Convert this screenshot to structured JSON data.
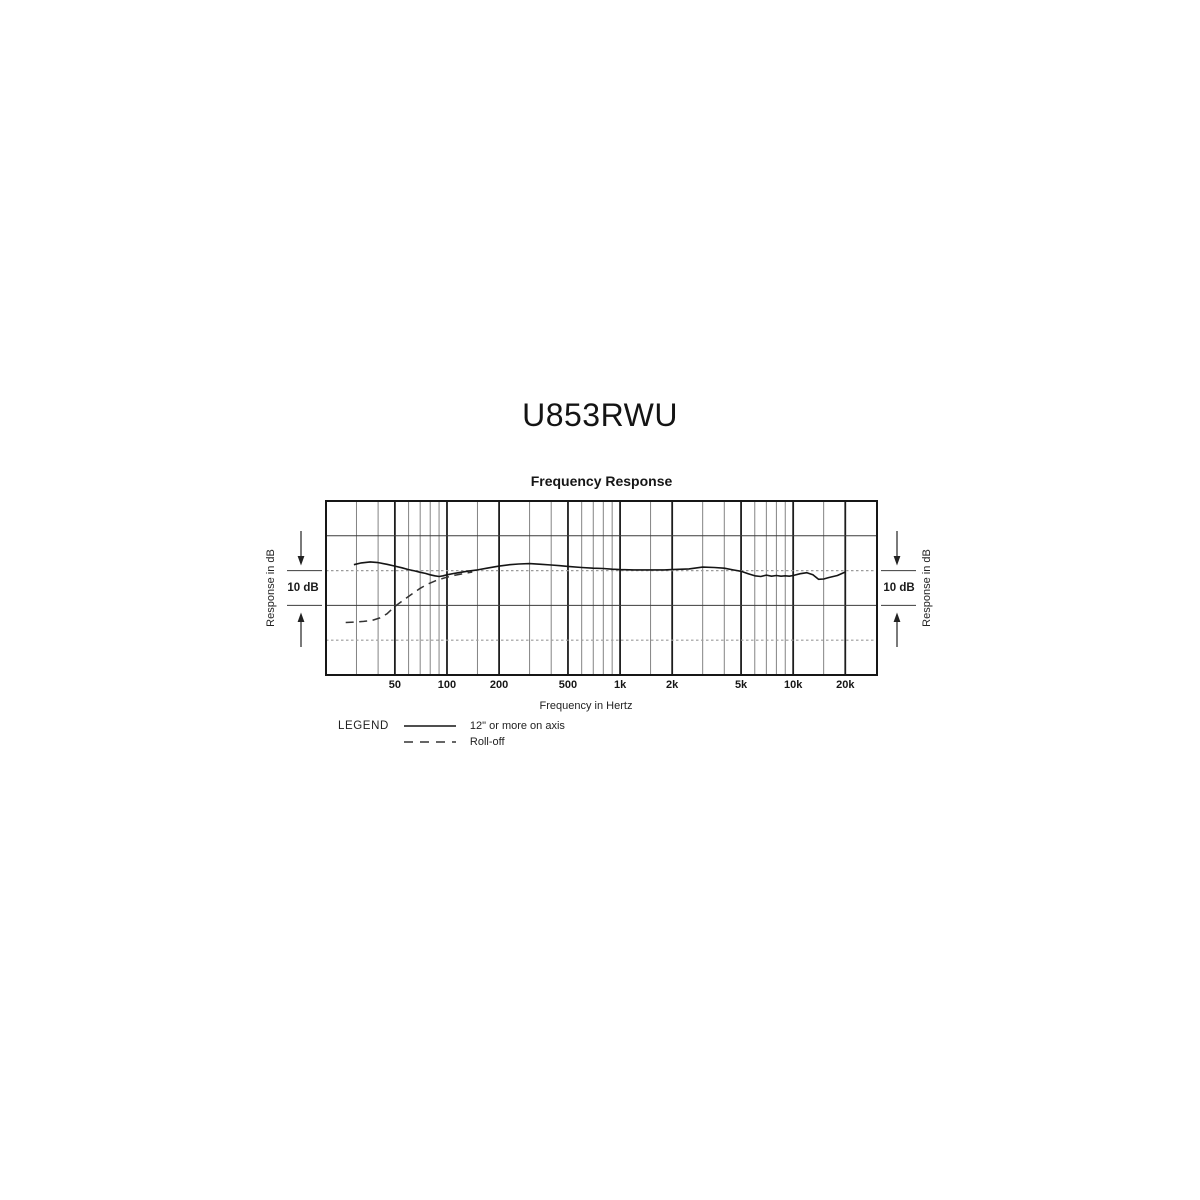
{
  "page": {
    "title": "U853RWU"
  },
  "chart": {
    "heading": "Frequency Response",
    "xlabel": "Frequency in Hertz",
    "ylabel_left": "Response in dB",
    "ylabel_right": "Response in dB",
    "scale_label": "10 dB",
    "legend": {
      "title": "LEGEND",
      "items": [
        {
          "style": "solid",
          "label": "12\" or more on axis"
        },
        {
          "style": "dashed",
          "label": "Roll-off"
        }
      ]
    }
  },
  "chart_data": {
    "type": "line",
    "title": "Frequency Response",
    "xlabel": "Frequency in Hertz",
    "ylabel": "Response in dB",
    "x_scale": "log",
    "x_unit": "Hz",
    "x_range": [
      20,
      30500
    ],
    "y_unit": "dB",
    "y_range": [
      -30,
      20
    ],
    "y_division_db": 10,
    "grid": true,
    "legend_position": "below-left",
    "major_ticks": [
      {
        "f": 50,
        "label": "50"
      },
      {
        "f": 100,
        "label": "100"
      },
      {
        "f": 200,
        "label": "200"
      },
      {
        "f": 500,
        "label": "500"
      },
      {
        "f": 1000,
        "label": "1k"
      },
      {
        "f": 2000,
        "label": "2k"
      },
      {
        "f": 5000,
        "label": "5k"
      },
      {
        "f": 10000,
        "label": "10k"
      },
      {
        "f": 20000,
        "label": "20k"
      }
    ],
    "minor_ticks": [
      30,
      40,
      60,
      70,
      80,
      90,
      150,
      300,
      400,
      600,
      700,
      800,
      900,
      1500,
      3000,
      4000,
      6000,
      7000,
      8000,
      9000,
      15000
    ],
    "reference_lines_db": {
      "solid": [
        10,
        -10
      ],
      "dashed": [
        0,
        -20
      ]
    },
    "series": [
      {
        "name": "12\" or more on axis",
        "style": "solid",
        "points": [
          [
            29,
            1.7
          ],
          [
            32,
            2.2
          ],
          [
            36,
            2.5
          ],
          [
            40,
            2.3
          ],
          [
            45,
            1.8
          ],
          [
            50,
            1.3
          ],
          [
            55,
            0.8
          ],
          [
            60,
            0.3
          ],
          [
            65,
            -0.1
          ],
          [
            70,
            -0.5
          ],
          [
            75,
            -0.8
          ],
          [
            80,
            -1.2
          ],
          [
            85,
            -1.5
          ],
          [
            90,
            -1.7
          ],
          [
            95,
            -1.5
          ],
          [
            100,
            -1.2
          ],
          [
            110,
            -0.8
          ],
          [
            120,
            -0.5
          ],
          [
            135,
            -0.1
          ],
          [
            150,
            0.2
          ],
          [
            170,
            0.7
          ],
          [
            200,
            1.3
          ],
          [
            230,
            1.7
          ],
          [
            260,
            1.9
          ],
          [
            300,
            2.0
          ],
          [
            350,
            1.8
          ],
          [
            400,
            1.6
          ],
          [
            450,
            1.4
          ],
          [
            500,
            1.2
          ],
          [
            600,
            0.9
          ],
          [
            700,
            0.7
          ],
          [
            800,
            0.6
          ],
          [
            900,
            0.4
          ],
          [
            1000,
            0.3
          ],
          [
            1200,
            0.2
          ],
          [
            1500,
            0.2
          ],
          [
            1800,
            0.2
          ],
          [
            2000,
            0.3
          ],
          [
            2500,
            0.5
          ],
          [
            3000,
            1.0
          ],
          [
            3500,
            0.9
          ],
          [
            4000,
            0.7
          ],
          [
            4500,
            0.2
          ],
          [
            5000,
            -0.2
          ],
          [
            5500,
            -0.9
          ],
          [
            6000,
            -1.5
          ],
          [
            6500,
            -1.7
          ],
          [
            7000,
            -1.3
          ],
          [
            7500,
            -1.6
          ],
          [
            8000,
            -1.4
          ],
          [
            8500,
            -1.6
          ],
          [
            9000,
            -1.5
          ],
          [
            9500,
            -1.6
          ],
          [
            10000,
            -1.4
          ],
          [
            11000,
            -0.9
          ],
          [
            12000,
            -0.6
          ],
          [
            13000,
            -1.2
          ],
          [
            14000,
            -2.5
          ],
          [
            15000,
            -2.4
          ],
          [
            16000,
            -2.0
          ],
          [
            18000,
            -1.4
          ],
          [
            20000,
            -0.4
          ]
        ]
      },
      {
        "name": "Roll-off",
        "style": "dashed",
        "points": [
          [
            26,
            -14.9
          ],
          [
            29,
            -14.8
          ],
          [
            33,
            -14.6
          ],
          [
            37,
            -14.3
          ],
          [
            41,
            -13.6
          ],
          [
            45,
            -12.4
          ],
          [
            50,
            -10.3
          ],
          [
            55,
            -8.8
          ],
          [
            62,
            -6.9
          ],
          [
            70,
            -5.1
          ],
          [
            78,
            -3.8
          ],
          [
            88,
            -2.7
          ],
          [
            100,
            -1.9
          ],
          [
            112,
            -1.3
          ],
          [
            126,
            -0.8
          ],
          [
            140,
            -0.4
          ]
        ]
      }
    ]
  },
  "colors": {
    "background": "#ffffff",
    "border": "#161616",
    "grid_major": "#1d1d1d",
    "grid_minor": "#848484",
    "ref_solid": "#3c3c3c",
    "ref_dashed": "#9b9b9b",
    "series_solid": "#151515",
    "series_dashed": "#333333",
    "annotation": "#222222"
  }
}
